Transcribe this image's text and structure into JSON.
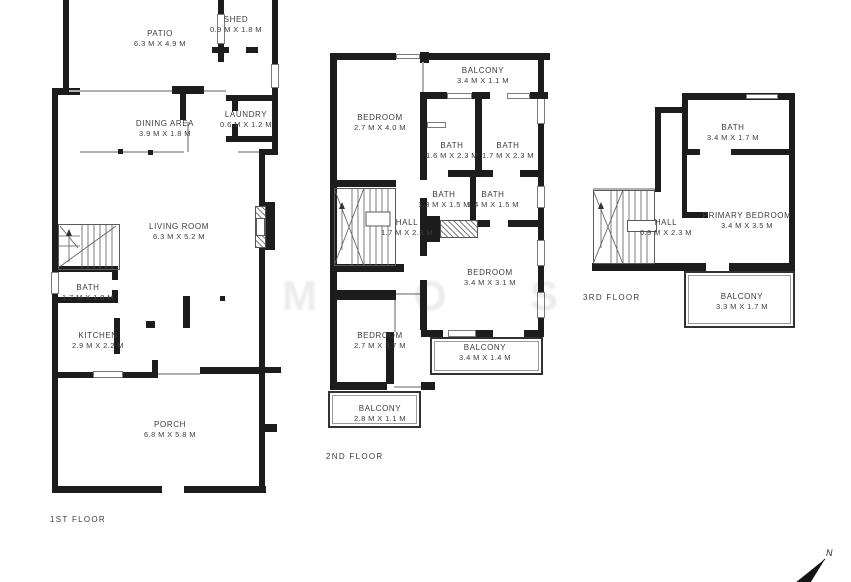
{
  "floors": [
    {
      "id": "floor-1",
      "label": "1ST FLOOR",
      "rooms": [
        {
          "key": "patio",
          "name": "PATIO",
          "dims": "6.3 M X 4.9 M"
        },
        {
          "key": "shed",
          "name": "SHED",
          "dims": "0.9 M X 1.8 M"
        },
        {
          "key": "dining-area",
          "name": "DINING AREA",
          "dims": "3.9 M X 1.8 M"
        },
        {
          "key": "laundry",
          "name": "LAUNDRY",
          "dims": "0.6 M X 1.2 M"
        },
        {
          "key": "living-room",
          "name": "LIVING ROOM",
          "dims": "6.3 M X 5.2 M"
        },
        {
          "key": "bath",
          "name": "BATH",
          "dims": "1.7 M X 1.0 M"
        },
        {
          "key": "kitchen",
          "name": "KITCHEN",
          "dims": "2.9 M X 2.2 M"
        },
        {
          "key": "porch",
          "name": "PORCH",
          "dims": "6.8 M X 5.8 M"
        }
      ]
    },
    {
      "id": "floor-2",
      "label": "2ND FLOOR",
      "rooms": [
        {
          "key": "balcony-top",
          "name": "BALCONY",
          "dims": "3.4 M X 1.1 M"
        },
        {
          "key": "bedroom-upper",
          "name": "BEDROOM",
          "dims": "2.7 M X 4.0 M"
        },
        {
          "key": "bath-1",
          "name": "BATH",
          "dims": "1.6 M X 2.3 M"
        },
        {
          "key": "bath-2",
          "name": "BATH",
          "dims": "1.7 M X 2.3 M"
        },
        {
          "key": "bath-3",
          "name": "BATH",
          "dims": "1.3 M X 1.5 M"
        },
        {
          "key": "bath-4",
          "name": "BATH",
          "dims": "1.4 M X 1.5 M"
        },
        {
          "key": "hall",
          "name": "HALL",
          "dims": "1.7 M X 2.3 M"
        },
        {
          "key": "bedroom-mid",
          "name": "BEDROOM",
          "dims": "3.4 M X 3.1 M"
        },
        {
          "key": "bedroom-lower",
          "name": "BEDROOM",
          "dims": "2.7 M X 3.7 M"
        },
        {
          "key": "balcony-right",
          "name": "BALCONY",
          "dims": "3.4 M X 1.4 M"
        },
        {
          "key": "balcony-bottom",
          "name": "BALCONY",
          "dims": "2.8 M X 1.1 M"
        }
      ]
    },
    {
      "id": "floor-3",
      "label": "3RD FLOOR",
      "rooms": [
        {
          "key": "bath",
          "name": "BATH",
          "dims": "3.4 M X 1.7 M"
        },
        {
          "key": "hall",
          "name": "HALL",
          "dims": "0.9 M X 2.3 M"
        },
        {
          "key": "primary-bedroom",
          "name": "PRIMARY BEDROOM",
          "dims": "3.4 M X 3.5 M"
        },
        {
          "key": "balcony",
          "name": "BALCONY",
          "dims": "3.3 M X 1.7 M"
        }
      ]
    }
  ],
  "compass": {
    "label": "N"
  },
  "watermark": {
    "letters": [
      "M",
      "O",
      "S"
    ]
  },
  "colors": {
    "wall": "#1d1d1d",
    "text": "#3c3c3c",
    "thin_line": "#b0b0b0",
    "background": "#ffffff"
  }
}
